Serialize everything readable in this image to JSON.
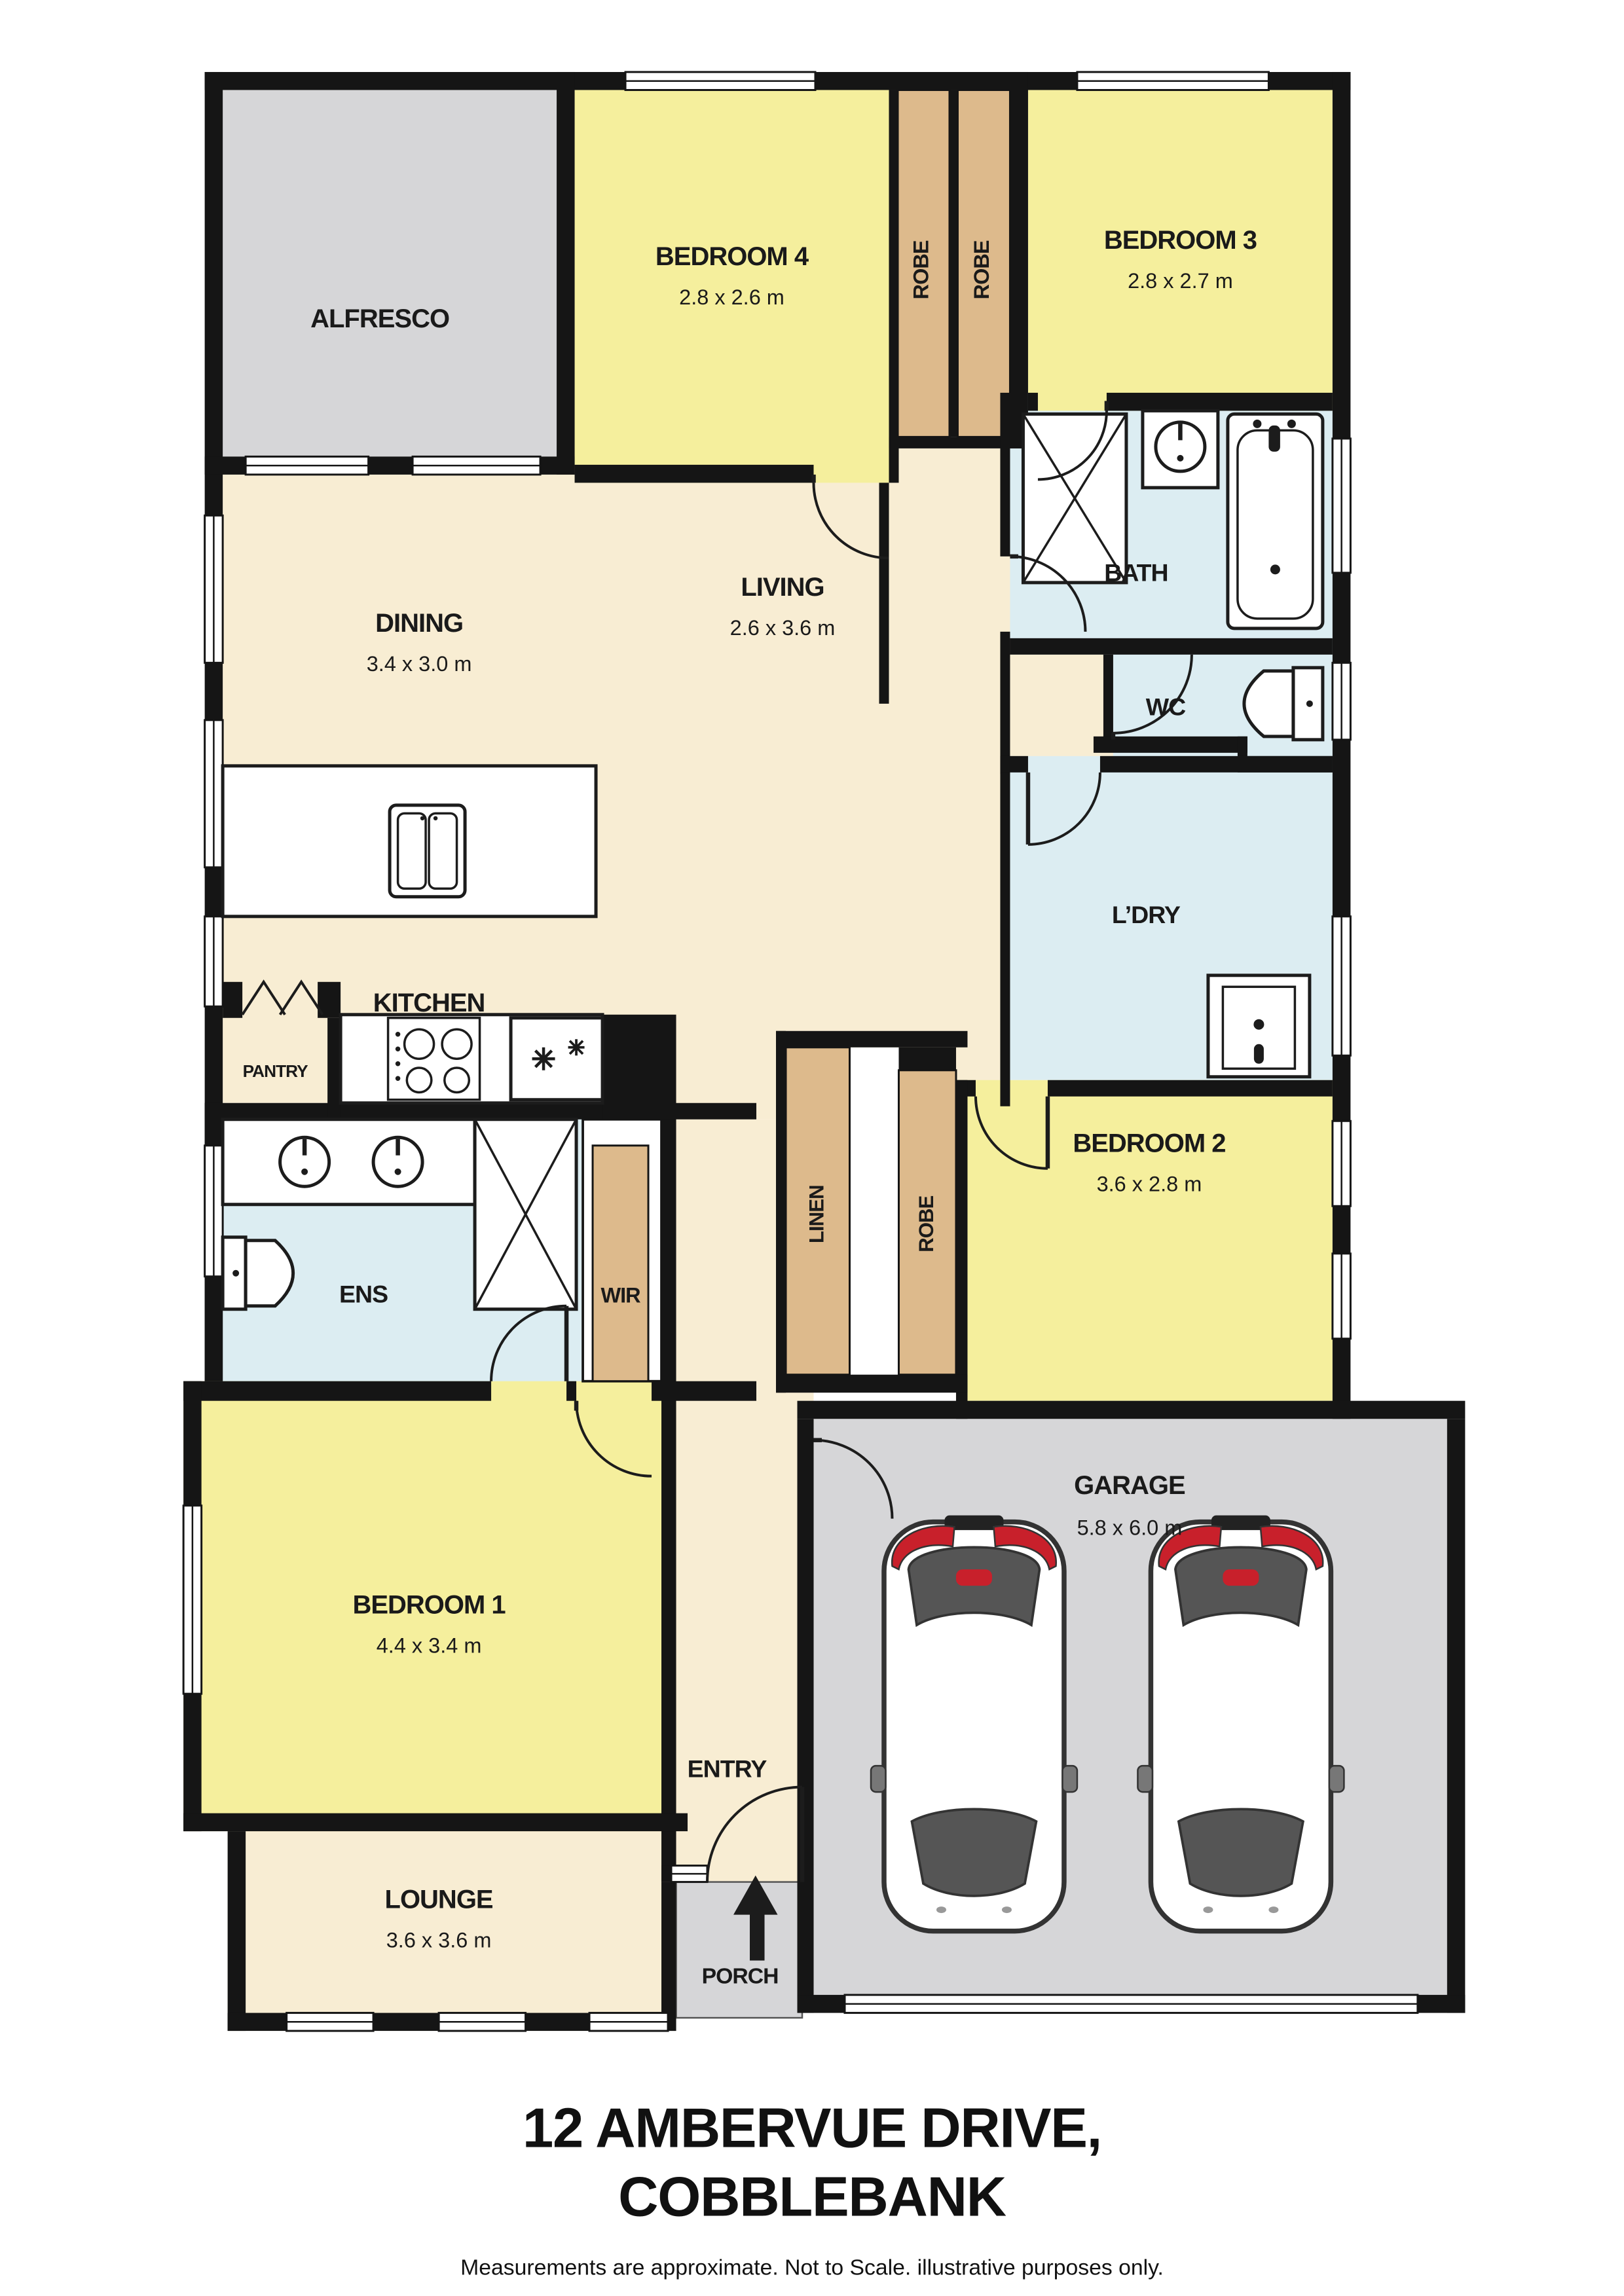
{
  "title": {
    "line1": "12 AMBERVUE DRIVE,",
    "line2": "COBBLEBANK",
    "disclaimer": "Measurements are approximate. Not to Scale. illustrative purposes only."
  },
  "rooms": {
    "alfresco": {
      "name": "ALFRESCO"
    },
    "bedroom4": {
      "name": "BEDROOM 4",
      "dims": "2.8 x 2.6 m"
    },
    "robe_left": {
      "name": "ROBE"
    },
    "robe_right": {
      "name": "ROBE"
    },
    "bedroom3": {
      "name": "BEDROOM 3",
      "dims": "2.8 x 2.7 m"
    },
    "dining": {
      "name": "DINING",
      "dims": "3.4 x 3.0 m"
    },
    "living": {
      "name": "LIVING",
      "dims": "2.6 x 3.6 m"
    },
    "bath": {
      "name": "BATH"
    },
    "wc": {
      "name": "WC"
    },
    "laundry": {
      "name": "L’DRY"
    },
    "kitchen": {
      "name": "KITCHEN"
    },
    "pantry": {
      "name": "PANTRY"
    },
    "ens": {
      "name": "ENS"
    },
    "wir": {
      "name": "WIR"
    },
    "linen": {
      "name": "LINEN"
    },
    "robe_bed2": {
      "name": "ROBE"
    },
    "bedroom2": {
      "name": "BEDROOM 2",
      "dims": "3.6 x 2.8 m"
    },
    "bedroom1": {
      "name": "BEDROOM 1",
      "dims": "4.4 x 3.4 m"
    },
    "garage": {
      "name": "GARAGE",
      "dims": "5.8 x 6.0 m"
    },
    "lounge": {
      "name": "LOUNGE",
      "dims": "3.6 x 3.6 m"
    },
    "entry": {
      "name": "ENTRY"
    },
    "porch": {
      "name": "PORCH"
    }
  },
  "colors": {
    "bedroom_fill": "#F5EF9D",
    "living_fill": "#F8EDD3",
    "wet_area_fill": "#DCEDF2",
    "robe_fill": "#DDBA8C",
    "outdoor_fill": "#D6D6D8",
    "wall": "#151515",
    "accent_red": "#C8202B"
  }
}
